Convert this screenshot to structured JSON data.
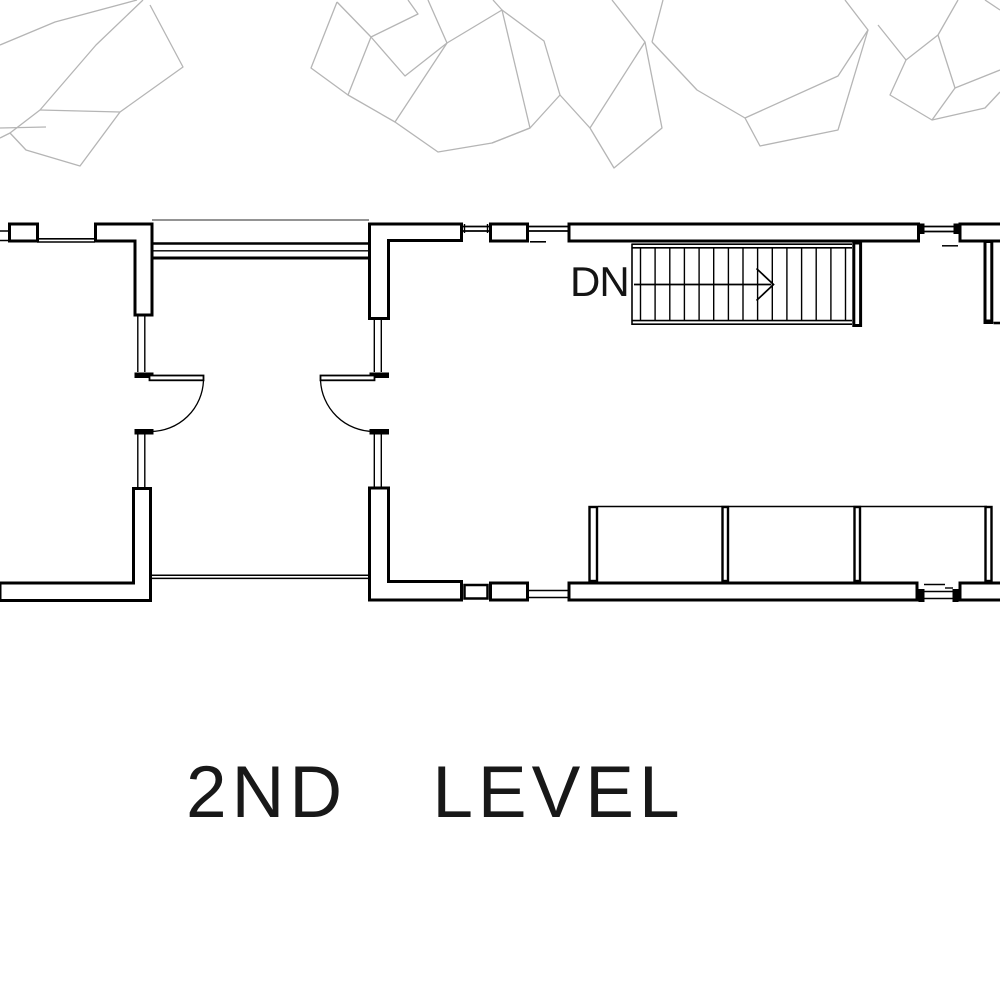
{
  "drawing": {
    "title": "2ND LEVEL",
    "stair": {
      "label": "DN",
      "tread_count": 15,
      "direction": "down",
      "arrow_points": "right"
    },
    "colors": {
      "background": "#ffffff",
      "wall_line": "#000000",
      "foliage_sketch": "#b5b5b5"
    }
  }
}
